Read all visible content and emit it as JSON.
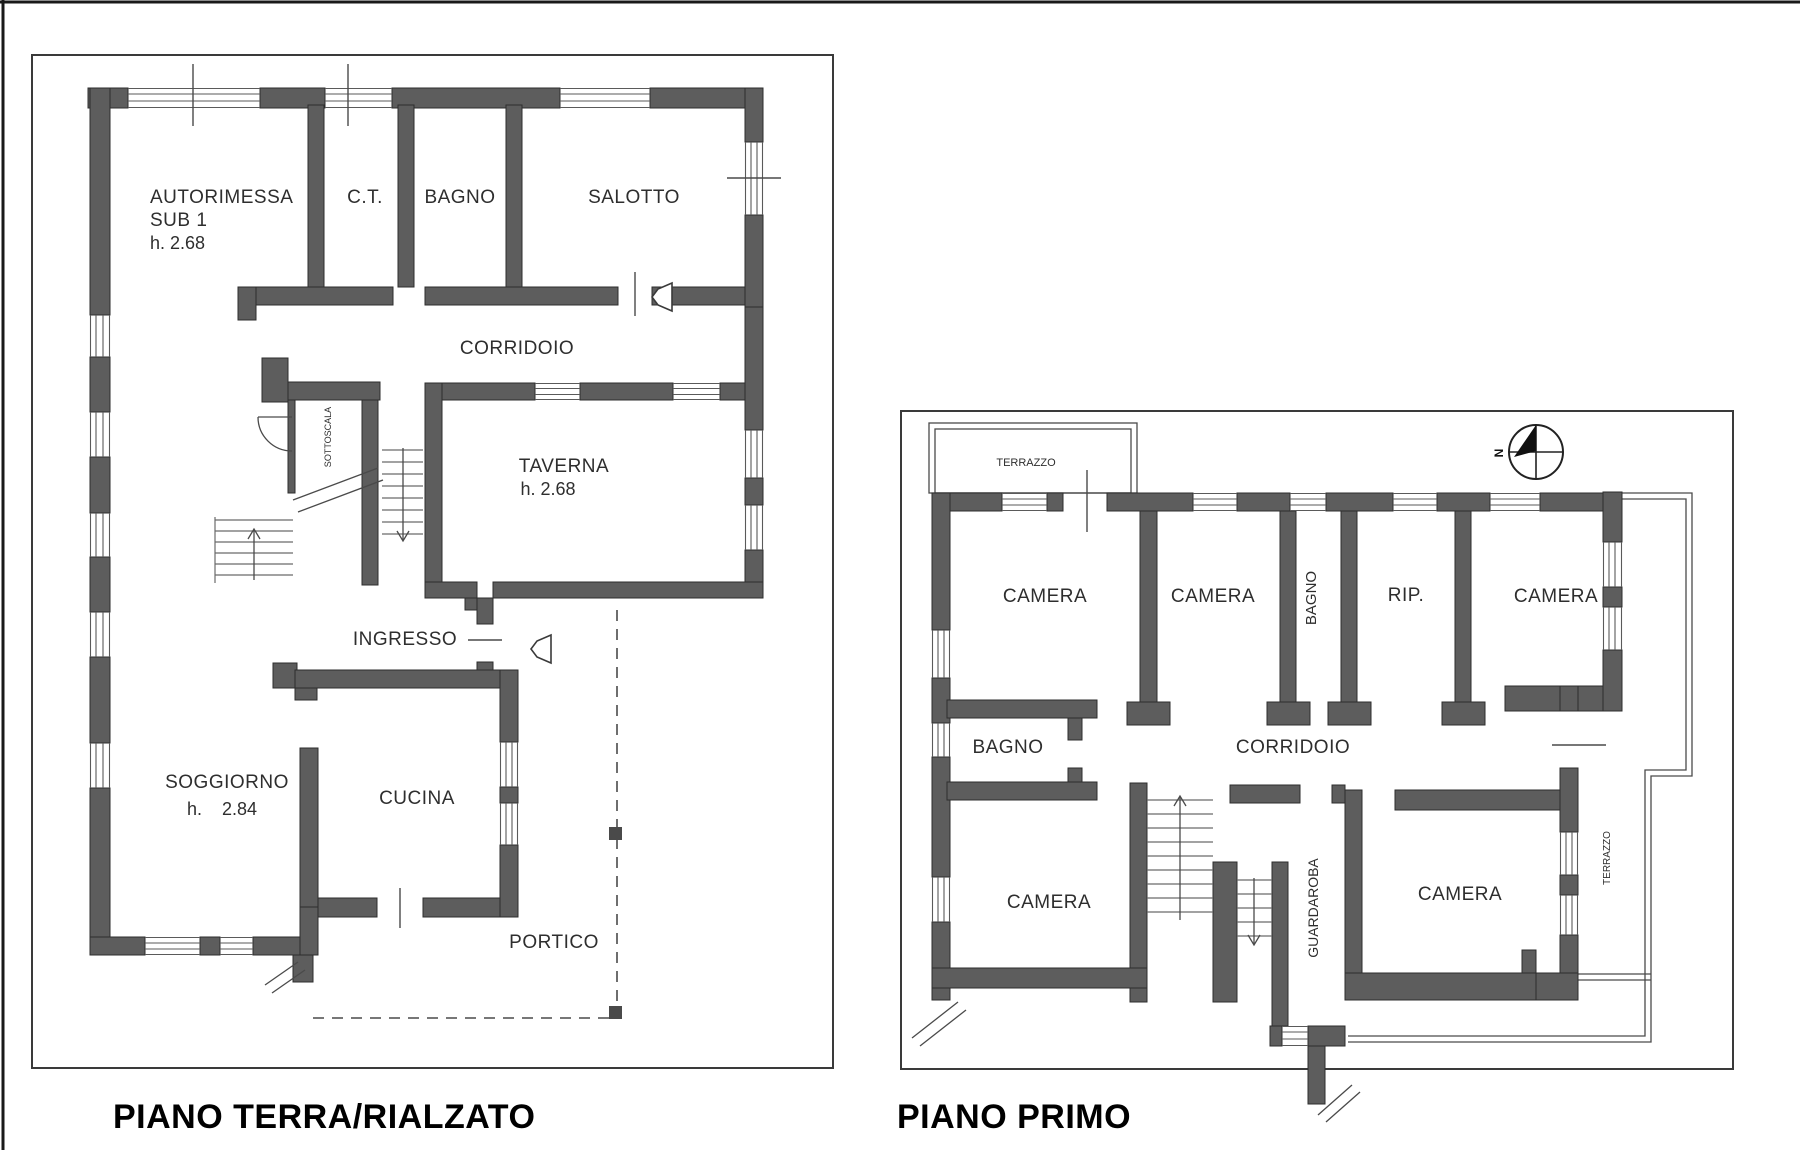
{
  "page": {
    "background": "#ffffff",
    "wall_color": "#5d5d5d",
    "line_color": "#4a4a4a"
  },
  "floor1": {
    "title": "PIANO TERRA/RIALZATO",
    "rooms": {
      "autorimessa_line1": "AUTORIMESSA",
      "autorimessa_line2": "SUB 1",
      "autorimessa_line3": "h. 2.68",
      "ct": "C.T.",
      "bagno": "BAGNO",
      "salotto": "SALOTTO",
      "corridoio": "CORRIDOIO",
      "sottoscala": "SOTTOSCALA",
      "taverna_line1": "TAVERNA",
      "taverna_line2": "h. 2.68",
      "ingresso": "INGRESSO",
      "soggiorno_line1": "SOGGIORNO",
      "soggiorno_line2": "h.    2.84",
      "cucina": "CUCINA",
      "portico": "PORTICO"
    }
  },
  "floor2": {
    "title": "PIANO PRIMO",
    "compass_letter": "N",
    "rooms": {
      "terrazzo_top": "TERRAZZO",
      "camera_nw": "CAMERA",
      "camera_n2": "CAMERA",
      "bagno_n": "BAGNO",
      "rip": "RIP.",
      "camera_ne": "CAMERA",
      "bagno_w": "BAGNO",
      "corridoio": "CORRIDOIO",
      "camera_sw": "CAMERA",
      "guardaroba": "GUARDAROBA",
      "camera_se": "CAMERA",
      "terrazzo_e": "TERRAZZO"
    }
  }
}
